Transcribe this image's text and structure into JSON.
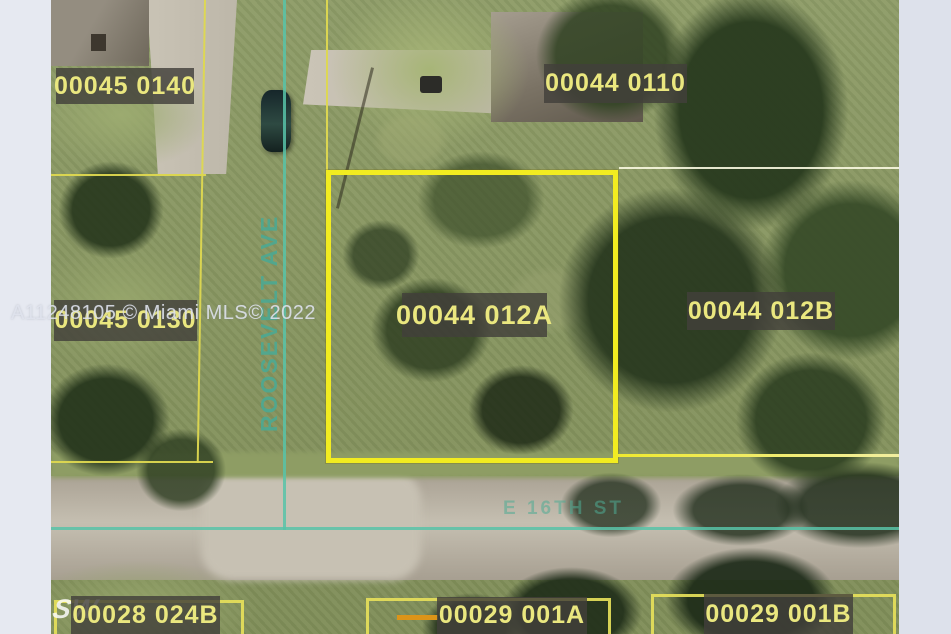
{
  "watermark": "A11248105 © Miami MLS© 2022",
  "streets": {
    "vertical": "ROOSEVELT AVE",
    "horizontal": "E 16TH ST",
    "corner_fragment": "SW"
  },
  "parcels": {
    "p0140": "00045 0140",
    "p0110": "00044 0110",
    "p0130": "00045 0130",
    "p012A": "00044 012A",
    "p012B": "00044 012B",
    "p024B": "00028 024B",
    "p001A": "00029 001A",
    "p001B": "00029 001B"
  },
  "colors": {
    "canvas_background": "#e3e6ef",
    "boundary_yellow_thick": "#f2ec20",
    "boundary_yellow_thin": "#ded850",
    "street_overlay_teal": "#58c3a8",
    "badge_background": "rgba(66,64,58,0.82)",
    "badge_text": "#eae77f",
    "orange_segment": "#dc9418"
  }
}
